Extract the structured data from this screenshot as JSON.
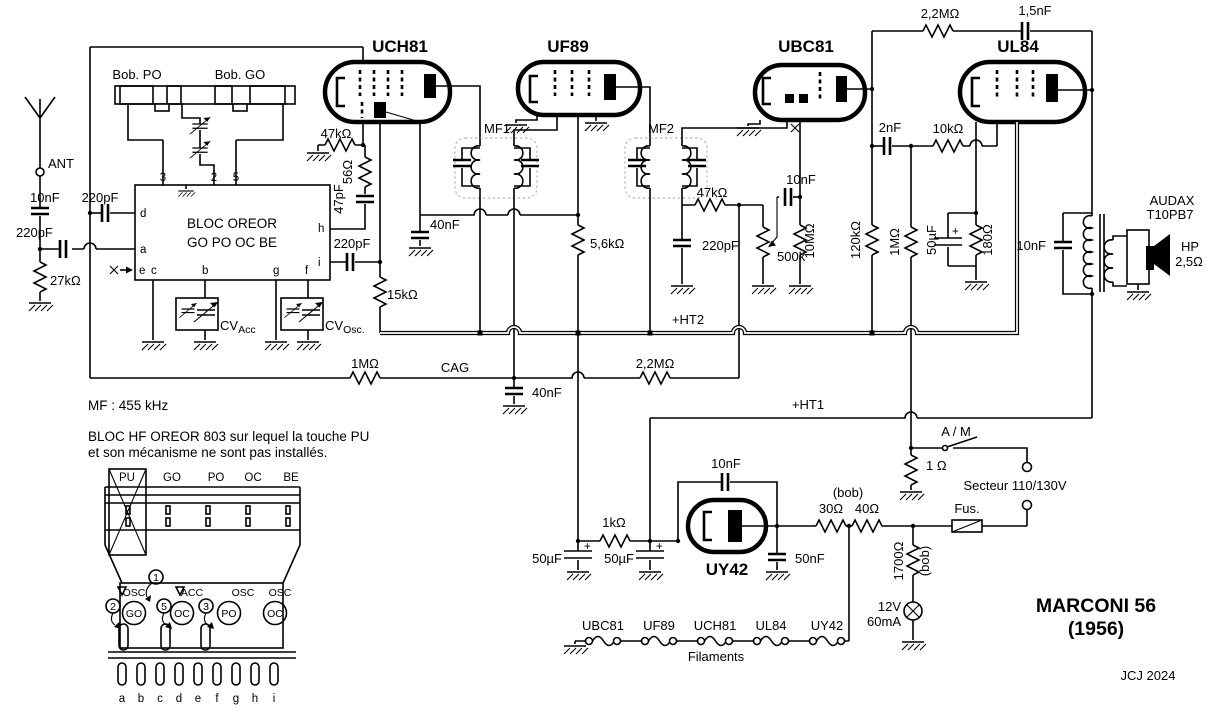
{
  "t": {
    "uch81": "UCH81",
    "uf89": "UF89",
    "ubc81": "UBC81",
    "ul84": "UL84",
    "uy42": "UY42",
    "ant": "ANT",
    "c10n_ant": "10nF",
    "c220_ant": "220pF",
    "r27k": "27kΩ",
    "c220_d": "220pF",
    "bob_po": "Bob. PO",
    "bob_go": "Bob. GO",
    "p3": "3",
    "p2": "2",
    "p5": "5",
    "pd": "d",
    "pa": "a",
    "pe": "e",
    "pc": "c",
    "pb": "b",
    "pg": "g",
    "pf": "f",
    "ph": "h",
    "pi": "i",
    "bloc1": "BLOC  OREOR",
    "bloc2": "GO  PO  OC  BE",
    "cv": "CV",
    "cv_acc": "Acc",
    "cv_osc": "Osc.",
    "r47k_g": "47kΩ",
    "r56": "56Ω",
    "c47p": "47pF",
    "c220_i": "220pF",
    "r15k": "15kΩ",
    "c40n_s": "40nF",
    "mf1": "MF1",
    "mf2": "MF2",
    "r5k6": "5,6kΩ",
    "r47k_d": "47kΩ",
    "c220_det": "220pF",
    "pot": "500k",
    "r10m": "10MΩ",
    "c10n_v": "10nF",
    "c2n": "2nF",
    "r10k": "10kΩ",
    "r120k": "120kΩ",
    "r1m_g": "1MΩ",
    "c50_k": "50µF",
    "r180": "180Ω",
    "plus": "+",
    "r2m2_fb": "2,2MΩ",
    "c1n5": "1,5nF",
    "c10n_o": "10nF",
    "audax": "AUDAX",
    "t10pb7": "T10PB7",
    "hp": "HP",
    "r2o5": "2,5Ω",
    "r1m_cag": "1MΩ",
    "cag": "CAG",
    "r2m2_cag": "2,2MΩ",
    "c40n_cag": "40nF",
    "ht2": "+HT2",
    "ht1": "+HT1",
    "c10n_uy": "10nF",
    "r1k": "1kΩ",
    "c50a": "50µF",
    "c50b": "50µF",
    "c50n": "50nF",
    "bob_lbl": "(bob)",
    "r30": "30Ω",
    "r40": "40Ω",
    "fus": "Fus.",
    "am": "A / M",
    "r1": "1 Ω",
    "secteur": "Secteur 110/130V",
    "r1700": "1700Ω",
    "bob2": "(bob)",
    "v12": "12V",
    "ma60": "60mA",
    "filaments": "Filaments",
    "mf_note": "MF :  455 kHz",
    "note1": "BLOC HF OREOR 803 sur lequel la touche PU",
    "note2": "et son mécanisme ne sont pas installés.",
    "marconi": "MARCONI  56",
    "year": "(1956)",
    "credit": "JCJ 2024"
  },
  "filament_chain": {
    "tubes": [
      "UBC81",
      "UF89",
      "UCH81",
      "UL84",
      "UY42"
    ]
  },
  "mech": {
    "keys": [
      "PU",
      "GO",
      "PO",
      "OC",
      "BE"
    ],
    "coils": [
      "OSC",
      "ACC",
      "OSC",
      "OSC"
    ],
    "sel": [
      "GO",
      "OC",
      "PO",
      "OC"
    ],
    "digits": [
      "1",
      "2",
      "5",
      "3"
    ],
    "pins": [
      "a",
      "b",
      "c",
      "d",
      "e",
      "f",
      "g",
      "h",
      "i"
    ]
  }
}
